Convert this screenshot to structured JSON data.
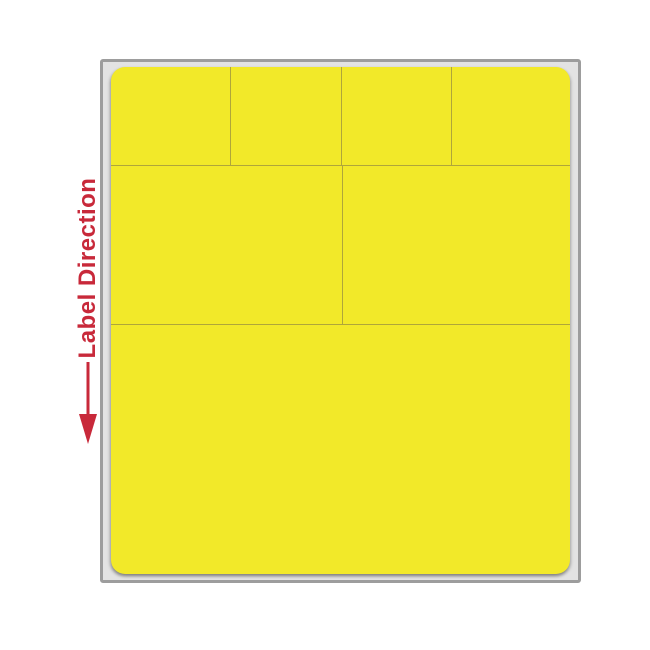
{
  "annotation": {
    "label": "Label Direction",
    "arrow_icon": "down-arrow",
    "color": "#c8293a"
  },
  "sheet": {
    "fill": "#f2e929",
    "divider_color": "#afa63a",
    "liner_border": "#9d9d9d",
    "liner_fill": "#e3e3e3",
    "rows": [
      {
        "name": "row-top",
        "height_pct": 19.5,
        "cell_widths_pct": [
          26.2,
          24.0,
          24.0,
          25.8
        ]
      },
      {
        "name": "row-middle",
        "height_pct": 31.2,
        "cell_widths_pct": [
          50.4,
          49.6
        ]
      },
      {
        "name": "row-bottom",
        "height_pct": 49.3,
        "cell_widths_pct": [
          100
        ]
      }
    ]
  }
}
